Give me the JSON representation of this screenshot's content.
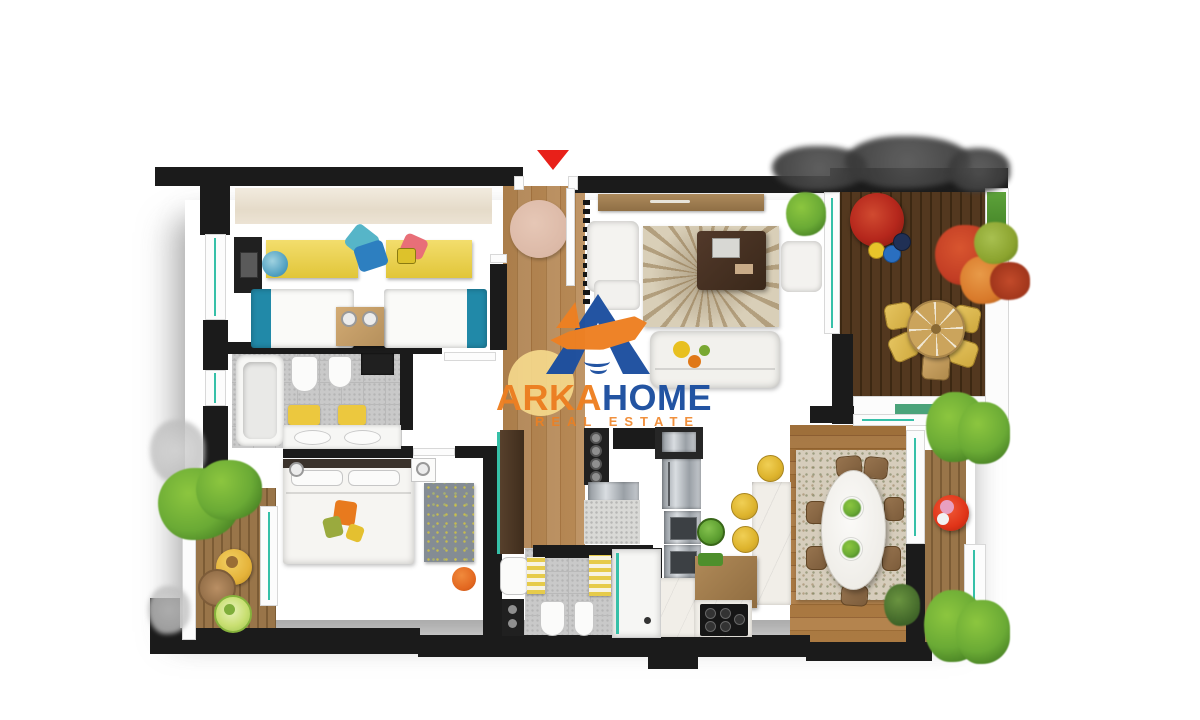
{
  "watermark": {
    "brand_primary": "ARKA",
    "brand_secondary": "HOME",
    "tagline": "REAL ESTATE"
  },
  "markers": {
    "entrance": {
      "icon": "arrow-down",
      "color": "#e82019"
    }
  },
  "palette": {
    "background": "#ffffff",
    "wall": "#1b1b1b",
    "wood_floor": "#b5854f",
    "pale_wood": "#eae1d2",
    "terrace_deck": "#503520",
    "balcony_deck": "#997549",
    "tile_gray": "#c9c9c9",
    "rug_yellow": "#efd23c",
    "rug_living": "#d9cfb8",
    "rug_dining": "#d6cdbc",
    "rug_master": "#848c94",
    "entry_rug": "#dcb9a7",
    "white_furniture": "#f5f4f1",
    "marble": "#f1eee8",
    "steel": "#aab0b6",
    "glass_teal": "#36c0a8",
    "pillow_teal": "#56b5c8",
    "pillow_blue": "#2d7fc0",
    "pillow_pink": "#e86f78",
    "blanket_teal": "#2189a8",
    "stool_yellow": "#ddb32c",
    "pouf_orange": "#e2661f",
    "bin_green": "#5c9e30",
    "plant_green": "#6aaa35",
    "plant_light": "#8cc63f",
    "plant_dark": "#3f6428",
    "autumn_red": "#c23d24",
    "autumn_orange": "#d8792a",
    "autumn_green": "#8ba32e",
    "terrace_red": "#b5271c",
    "table_red": "#e03418",
    "logo_blue": "#1c4fa0",
    "logo_orange": "#ee8022",
    "logo_yellow": "#f5d98c",
    "entrance_red": "#e82019",
    "silhouette_gray": "#4a4a4a"
  }
}
